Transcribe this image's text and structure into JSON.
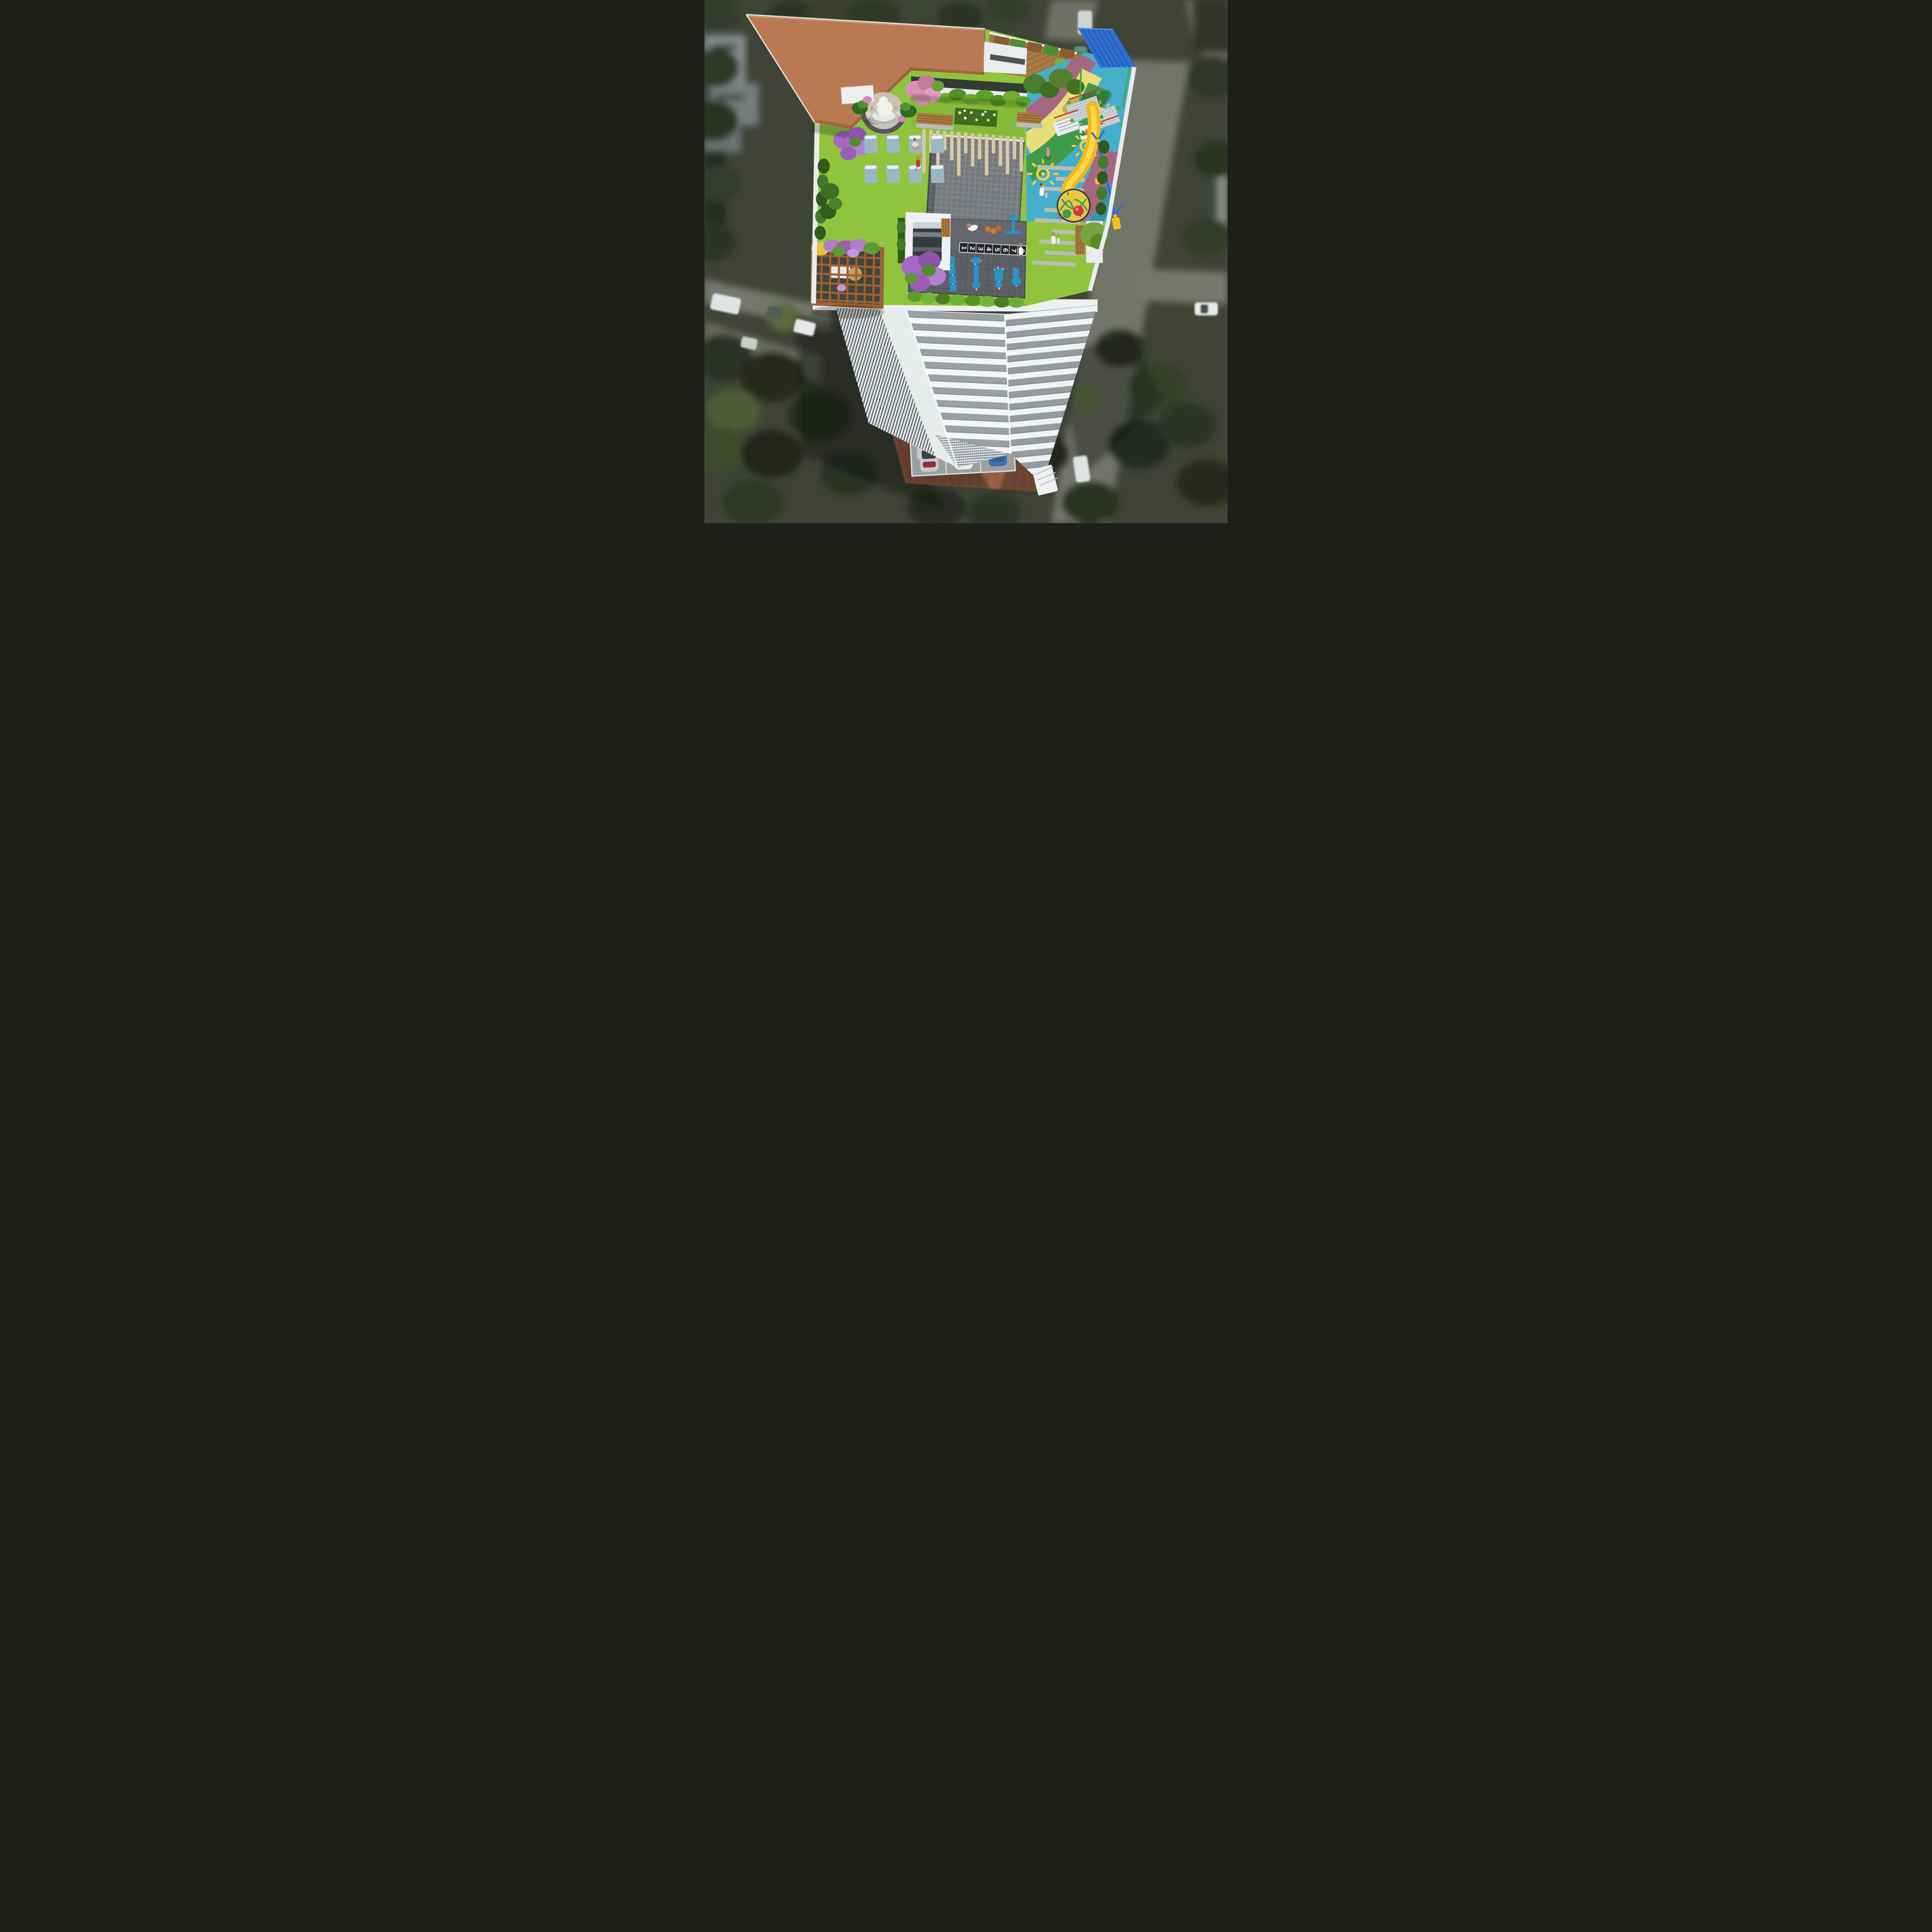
{
  "meta": {
    "title": "Aerial 3D architectural render — high-rise tower with rooftop amenity terrace",
    "view": "top-down bird's-eye",
    "style": "photoreal render, background city blurred (tilt-shift)"
  },
  "rooftop": {
    "areas": {
      "frame": "terracotta pergola frame (L-shaped)",
      "buddha": "buddha statue on pebble court",
      "yoga": "yoga lawn with mats",
      "plaza": "grey paver multipurpose plaza",
      "playground": "kids play zone with multicolour rubber floor",
      "gym": "open-air gym on dark tiles",
      "deck": "timber deck with green-wall screens",
      "pergola": "timber trellis gazebo with flowering creepers",
      "reflexology": "lawns with timber / stone strip inlays"
    },
    "hopscotch_numbers": [
      "1",
      "2",
      "3",
      "4",
      "5",
      "6",
      "7",
      "8"
    ],
    "counts": {
      "yoga_mats": 8,
      "gym_machines": 5,
      "painted_suns": 3,
      "benches": 5
    }
  },
  "ground": {
    "parked_cars": [
      {
        "color": "silver"
      },
      {
        "color": "white"
      },
      {
        "color": "blue"
      }
    ],
    "surface": "brick-paved drop-off court"
  },
  "palette": {
    "terracotta": "#b97a53",
    "lawn_green": "#8fc43c",
    "plaza_gray": "#7d8186",
    "gym_tile": "#5d6166",
    "play_blue": "#45aecb",
    "play_yellow": "#e8de7a",
    "play_green": "#3f9a4d",
    "play_mauve": "#a6687f",
    "slide_yellow": "#f2b818",
    "canopy_blue": "#2f6fd4",
    "equipment_blue": "#2893c6",
    "wood": "#a87a46",
    "facade_white": "#f2f4f5",
    "slab_gray": "#9ba0a4",
    "background_olive": "#3f4437"
  }
}
